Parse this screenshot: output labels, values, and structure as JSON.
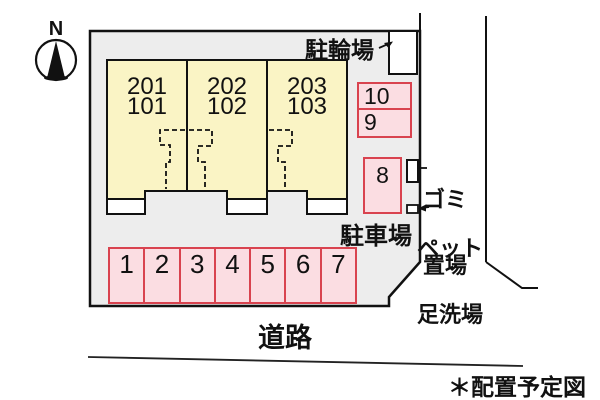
{
  "compass": {
    "label": "N"
  },
  "site": {
    "building": {
      "units": [
        {
          "upper": "201",
          "lower": "101"
        },
        {
          "upper": "202",
          "lower": "102"
        },
        {
          "upper": "203",
          "lower": "103"
        }
      ]
    },
    "bicycle_parking": {
      "label": "駐輪場"
    },
    "garbage_area": {
      "lines": [
        "ゴミ",
        "置場"
      ]
    },
    "pet_wash": {
      "lines": [
        "ペット",
        "足洗場"
      ]
    },
    "parking_lot": {
      "label": "駐車場",
      "row_spaces": [
        "1",
        "2",
        "3",
        "4",
        "5",
        "6",
        "7"
      ],
      "side_spaces": [
        "10",
        "9",
        "8"
      ]
    }
  },
  "road": {
    "label": "道路"
  },
  "footnote": {
    "label": "＊配置予定図"
  },
  "colors": {
    "site_fill": "#ededed",
    "building_fill": "#faf4c5",
    "space_fill": "#fbdde2",
    "space_border": "#d9434f",
    "line": "#111111"
  }
}
